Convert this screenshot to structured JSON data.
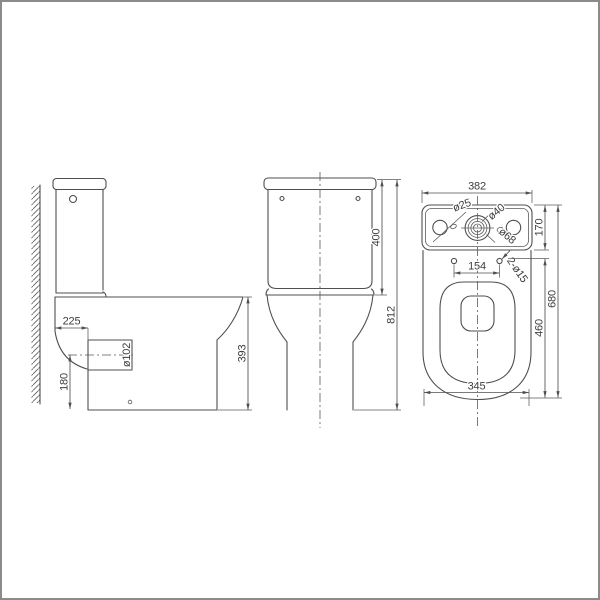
{
  "colors": {
    "background": "#ffffff",
    "line": "#4f4f4f",
    "dimension_line": "#5a5a5a",
    "text": "#3d3d3d",
    "border": "#8b8b8b"
  },
  "views": {
    "side": {
      "dims": {
        "outlet_setout": "225",
        "outlet_diameter": "ø102",
        "outlet_axis_height": "180",
        "bowl_height": "393"
      }
    },
    "front": {
      "dims": {
        "tank_height": "400",
        "total_height": "812"
      }
    },
    "top": {
      "dims": {
        "overall_width": "382",
        "tank_depth": "170",
        "lid_hole": "ø25",
        "inlet_hole": "ø40",
        "flush_hole": "ø68",
        "hinge_hole_spacing": "154",
        "hinge_holes": "2-ø15",
        "overall_depth": "680",
        "seat_depth": "460",
        "base_width": "345"
      }
    }
  }
}
